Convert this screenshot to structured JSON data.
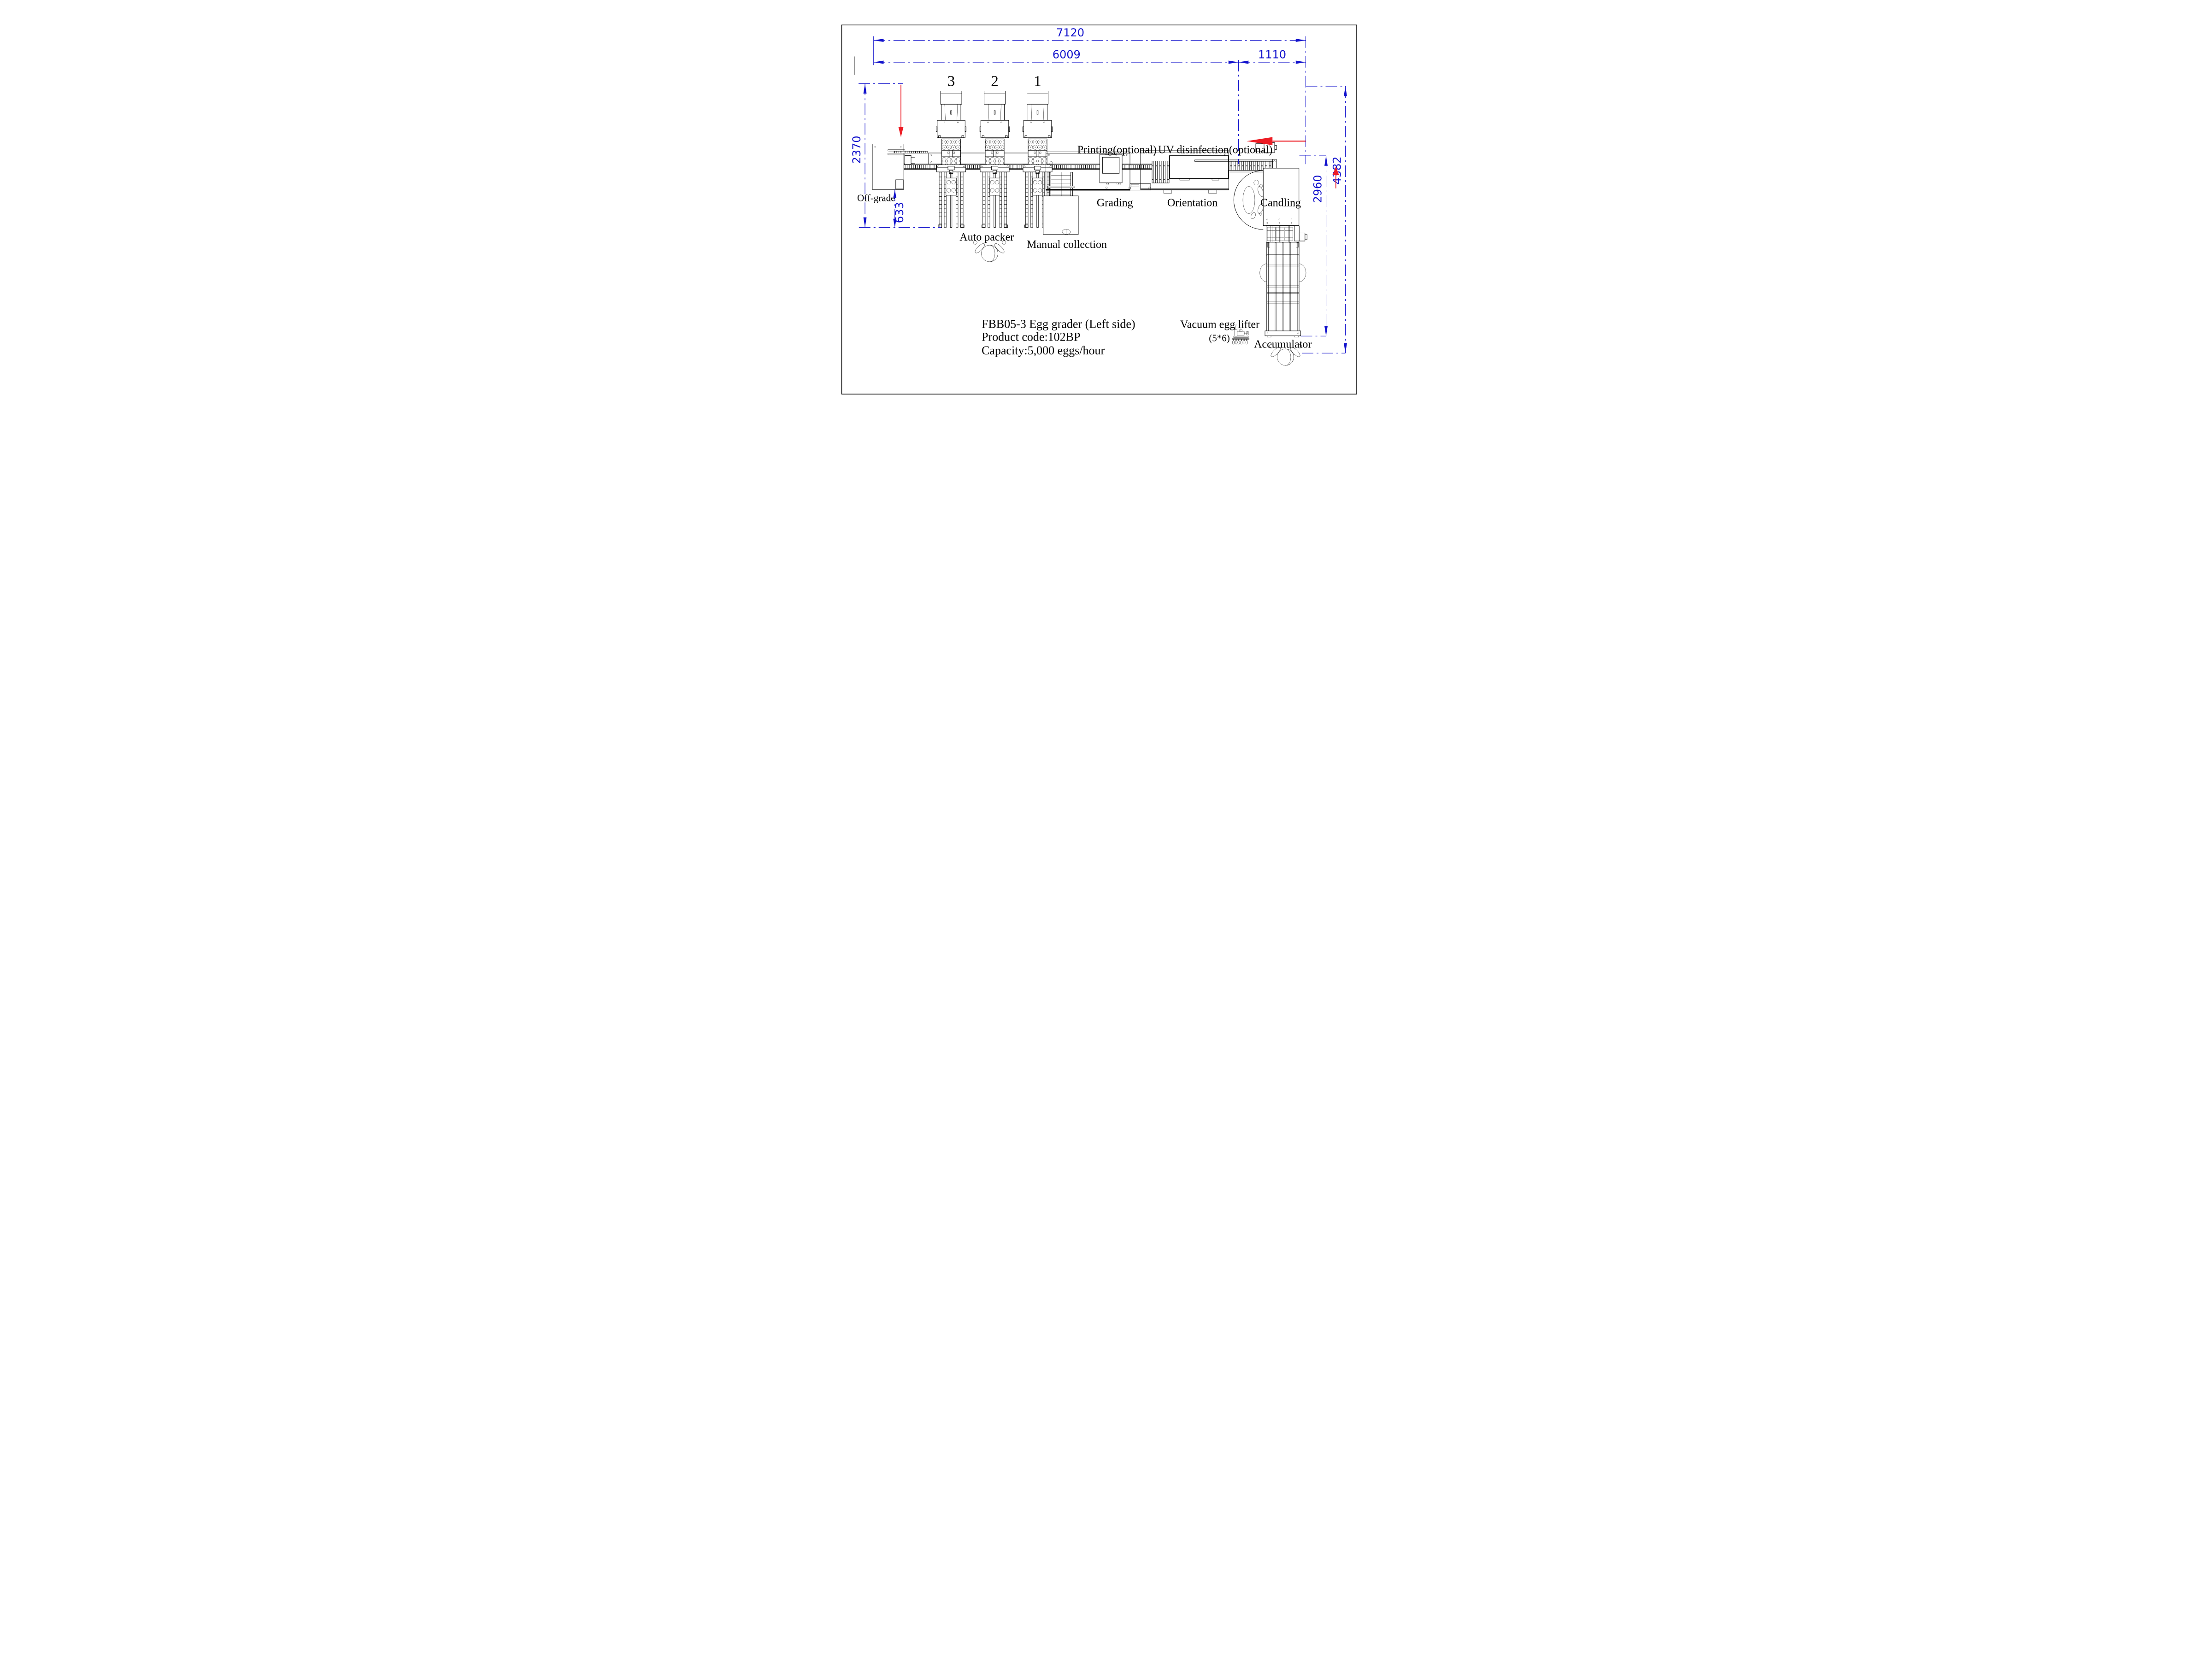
{
  "drawing": {
    "type": "machine layout plan",
    "view": "top view, left side configuration"
  },
  "colors": {
    "line": "#000000",
    "dimension": "#1212cc",
    "flow_arrow": "#ed1c24",
    "background": "#ffffff"
  },
  "dimensions": {
    "total_length": "7120",
    "main_length": "6009",
    "right_offset": "1110",
    "packer_depth": "2370",
    "offgrade_offset": "633",
    "accumulator_height": "2960",
    "total_height": "4382"
  },
  "packers": [
    {
      "label": "3"
    },
    {
      "label": "2"
    },
    {
      "label": "1"
    }
  ],
  "labels": {
    "off_grade": "Off-grade",
    "auto_packer": "Auto packer",
    "manual_collection": "Manual collection",
    "grading": "Grading",
    "printing": "Printing(optional)",
    "uv": "UV disinfection(optional)",
    "orientation": "Orientation",
    "candling": "Candling",
    "vacuum_lifter": "Vacuum egg lifter",
    "vacuum_lifter_size": "(5*6)",
    "accumulator": "Accumulator"
  },
  "title_block": {
    "line1": "FBB05-3 Egg grader (Left side)",
    "line2": "Product code:102BP",
    "line3": "Capacity:5,000  eggs/hour"
  }
}
